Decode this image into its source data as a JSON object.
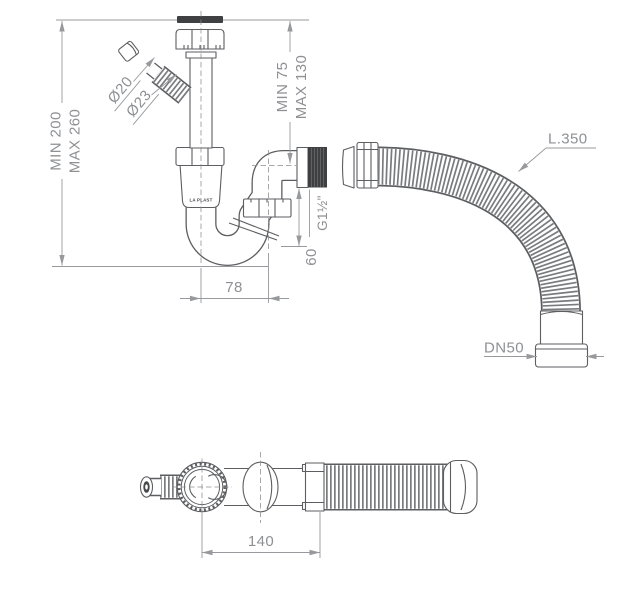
{
  "drawing": {
    "brand_logo": "LA PLAST",
    "labels": {
      "height_min": "MIN 200",
      "height_max": "MAX 260",
      "tail_min": "MIN 75",
      "tail_max": "MAX 130",
      "dia_branch_small": "Ø20",
      "dia_branch_large": "Ø23",
      "thread_size": "G1½\"",
      "dim_60": "60",
      "dim_78": "78",
      "hose_length": "L.350",
      "outlet_size": "DN50",
      "dim_140": "140"
    },
    "colors": {
      "part_line": "#5d5e61",
      "dimension_line": "#97999c",
      "text": "#8e9093",
      "dark_fill": "#3f4042",
      "background": "#ffffff"
    }
  }
}
